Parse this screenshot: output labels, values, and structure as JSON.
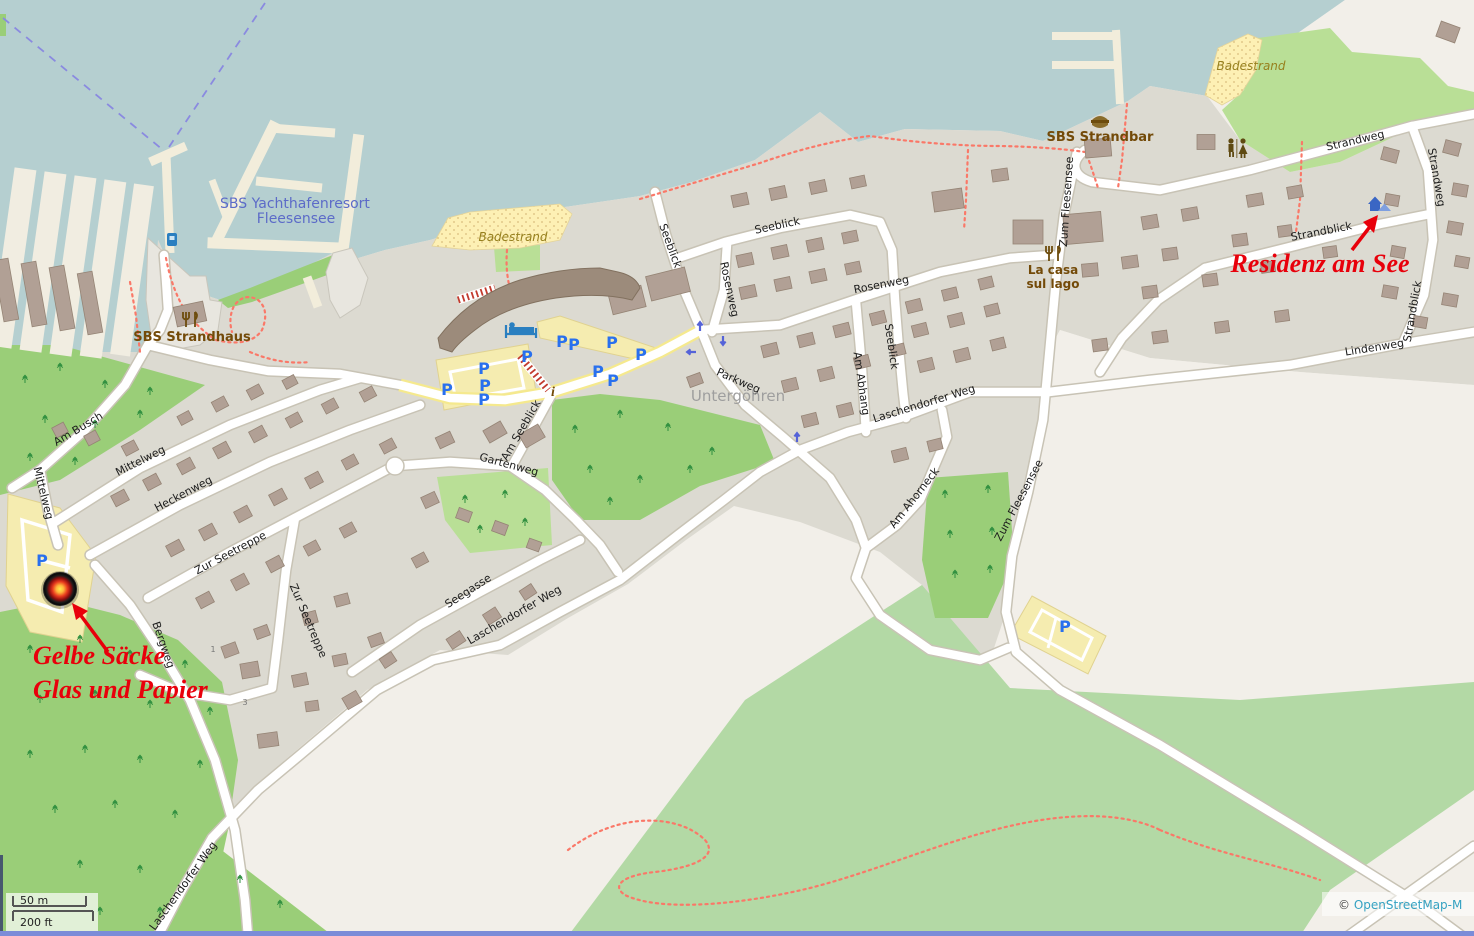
{
  "streets": [
    {
      "name": "Strandweg"
    },
    {
      "name": "Strandweg"
    },
    {
      "name": "Strandblick"
    },
    {
      "name": "Strandblick"
    },
    {
      "name": "Lindenweg"
    },
    {
      "name": "Zum Fleesensee"
    },
    {
      "name": "Zum Fleesensee"
    },
    {
      "name": "Seeblick"
    },
    {
      "name": "Seeblick"
    },
    {
      "name": "Seeblick"
    },
    {
      "name": "Rosenweg"
    },
    {
      "name": "Rosenweg"
    },
    {
      "name": "Parkweg"
    },
    {
      "name": "Am Abhang"
    },
    {
      "name": "Laschendorfer Weg"
    },
    {
      "name": "Laschendorfer Weg"
    },
    {
      "name": "Laschendorfer Weg"
    },
    {
      "name": "Seegasse"
    },
    {
      "name": "Gartenweg"
    },
    {
      "name": "Am Seeblick"
    },
    {
      "name": "Am Busch"
    },
    {
      "name": "Mittelweg"
    },
    {
      "name": "Mittelweg"
    },
    {
      "name": "Heckenweg"
    },
    {
      "name": "Zur Seetreppe"
    },
    {
      "name": "Zur Seetreppe"
    },
    {
      "name": "Bergweg"
    },
    {
      "name": "Am Ahorneck"
    }
  ],
  "pois": {
    "yacht_resort_line1": "SBS Yachthafenresort",
    "yacht_resort_line2": "Fleesensee",
    "strandhaus": "SBS Strandhaus",
    "strandbar": "SBS Strandbar",
    "la_casa_line1": "La casa",
    "la_casa_line2": "sul lago",
    "badestrand_mid": "Badestrand",
    "badestrand_ne": "Badestrand"
  },
  "place": {
    "untergoehren": "Untergöhren"
  },
  "annotations": {
    "residenz": "Residenz am See",
    "gelbe_line1": "Gelbe Säcke",
    "gelbe_line2": "Glas und Papier"
  },
  "symbols": {
    "parking": "P",
    "info": "i"
  },
  "housenumbers": {
    "n1": "1",
    "n3": "3"
  },
  "scalebar": {
    "metric": "50 m",
    "imperial": "200 ft"
  },
  "attribution": {
    "copyright": "© ",
    "link": "OpenStreetMap-M"
  },
  "colors": {
    "water": "#b5cfd0",
    "urban": "#dcdad1",
    "land": "#f2efe9",
    "forest": "#9ace78",
    "meadow": "#b3d9a5",
    "light_green": "#c3e49e",
    "building": "#b1a095",
    "beach": "#fdf0b4",
    "road": "#ffffff",
    "annotation_red": "#e8000b",
    "parking_blue": "#2970ee",
    "poi_brown": "#734a08",
    "water_label_blue": "#5c6bc8",
    "path_red": "#fa7868"
  }
}
